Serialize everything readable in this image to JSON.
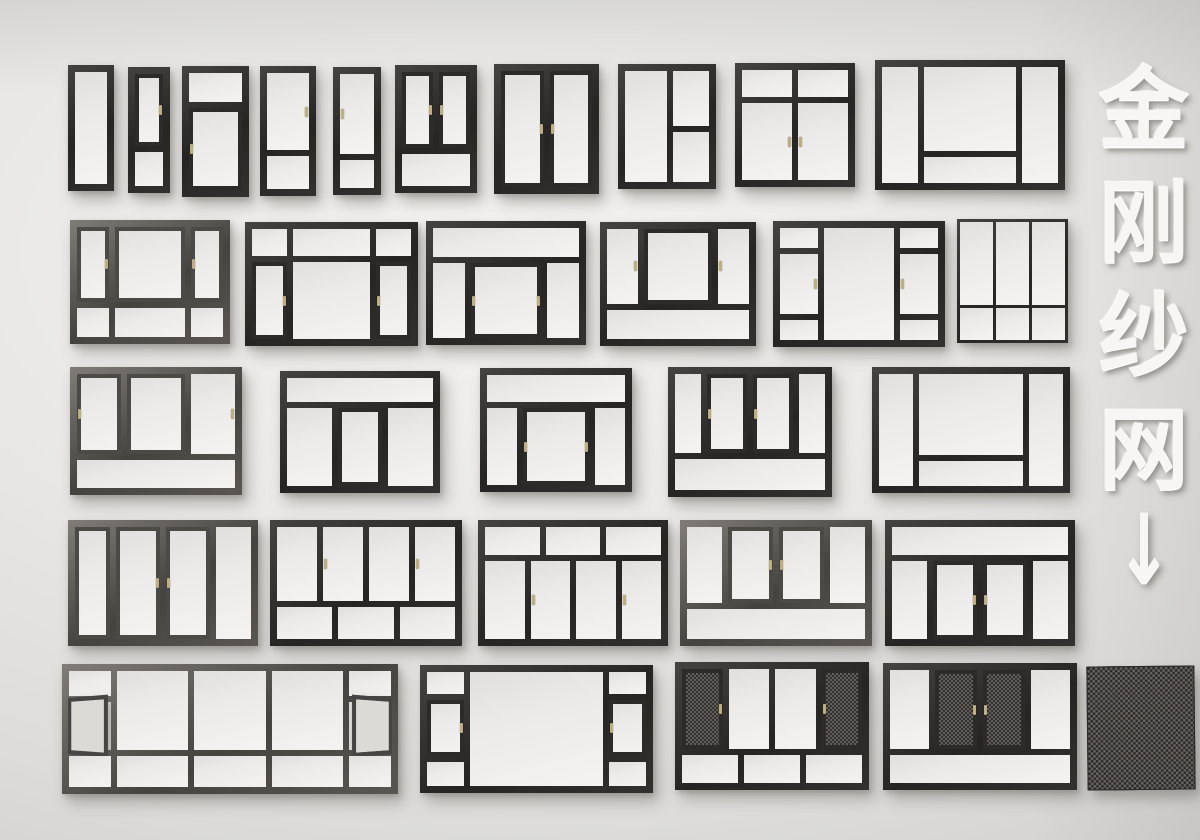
{
  "scene": {
    "title_vertical": {
      "text": "金刚纱网",
      "chars": [
        "金",
        "刚",
        "纱",
        "网"
      ],
      "arrow": "↓"
    },
    "colors": {
      "wall": "#e9e8e6",
      "frame_dark": "#2c2b29",
      "frame_steel": "#56534f",
      "glass": "#efeeec",
      "mesh": "#3f3d3b",
      "handle": "#bfae7f",
      "title_text": "#f7f6f4"
    }
  },
  "windows": [
    {
      "x": 68,
      "y": 65,
      "w": 46,
      "h": 126,
      "tone": "dark",
      "cols": "1fr",
      "rows": "1fr",
      "panes": [
        {
          "c": "1",
          "r": "1",
          "t": "g"
        }
      ]
    },
    {
      "x": 128,
      "y": 67,
      "w": 42,
      "h": 126,
      "tone": "dark",
      "cols": "1fr",
      "rows": "68fr 32fr",
      "panes": [
        {
          "c": "1",
          "r": "1",
          "t": "s",
          "h": "r"
        },
        {
          "c": "1",
          "r": "2",
          "t": "g"
        }
      ]
    },
    {
      "x": 182,
      "y": 66,
      "w": 67,
      "h": 131,
      "tone": "dark",
      "cols": "1fr",
      "rows": "26fr 74fr",
      "panes": [
        {
          "c": "1",
          "r": "1",
          "t": "g"
        },
        {
          "c": "1",
          "r": "2",
          "t": "s",
          "h": "l"
        }
      ]
    },
    {
      "x": 260,
      "y": 66,
      "w": 56,
      "h": 130,
      "tone": "dark",
      "cols": "1fr",
      "rows": "70fr 30fr",
      "panes": [
        {
          "c": "1",
          "r": "1",
          "t": "g",
          "h": "r"
        },
        {
          "c": "1",
          "r": "2",
          "t": "g"
        }
      ]
    },
    {
      "x": 333,
      "y": 67,
      "w": 48,
      "h": 128,
      "tone": "dark",
      "cols": "1fr",
      "rows": "74fr 26fr",
      "panes": [
        {
          "c": "1",
          "r": "1",
          "t": "g",
          "h": "l"
        },
        {
          "c": "1",
          "r": "2",
          "t": "g"
        }
      ]
    },
    {
      "x": 395,
      "y": 65,
      "w": 82,
      "h": 128,
      "tone": "dark",
      "cols": "1fr 1fr",
      "rows": "70fr 30fr",
      "panes": [
        {
          "c": "1",
          "r": "1",
          "t": "s",
          "h": "r"
        },
        {
          "c": "2",
          "r": "1",
          "t": "s",
          "h": "l"
        },
        {
          "c": "1/3",
          "r": "2",
          "t": "g"
        }
      ]
    },
    {
      "x": 494,
      "y": 64,
      "w": 105,
      "h": 130,
      "tone": "dark",
      "cols": "1fr 1fr",
      "rows": "1fr",
      "panes": [
        {
          "c": "1",
          "r": "1",
          "t": "s",
          "h": "r"
        },
        {
          "c": "2",
          "r": "1",
          "t": "s",
          "h": "l"
        }
      ]
    },
    {
      "x": 618,
      "y": 64,
      "w": 98,
      "h": 125,
      "tone": "dark",
      "cols": "54fr 46fr",
      "rows": "52fr 48fr",
      "panes": [
        {
          "c": "1",
          "r": "1/3",
          "t": "g"
        },
        {
          "c": "2",
          "r": "1",
          "t": "g"
        },
        {
          "c": "2",
          "r": "2",
          "t": "g"
        }
      ]
    },
    {
      "x": 735,
      "y": 63,
      "w": 120,
      "h": 124,
      "tone": "dark",
      "cols": "1fr 1fr",
      "rows": "26fr 74fr",
      "panes": [
        {
          "c": "1",
          "r": "1",
          "t": "g"
        },
        {
          "c": "2",
          "r": "1",
          "t": "g"
        },
        {
          "c": "1",
          "r": "2",
          "t": "g",
          "h": "r"
        },
        {
          "c": "2",
          "r": "2",
          "t": "g",
          "h": "l"
        }
      ]
    },
    {
      "x": 875,
      "y": 60,
      "w": 190,
      "h": 130,
      "tone": "dark",
      "cols": "22fr 56fr 22fr",
      "rows": "76fr 24fr",
      "panes": [
        {
          "c": "1",
          "r": "1/3",
          "t": "g"
        },
        {
          "c": "2",
          "r": "1",
          "t": "g"
        },
        {
          "c": "2",
          "r": "2",
          "t": "g"
        },
        {
          "c": "3",
          "r": "1/3",
          "t": "g"
        }
      ]
    },
    {
      "x": 70,
      "y": 220,
      "w": 160,
      "h": 124,
      "tone": "steel",
      "cols": "24fr 52fr 24fr",
      "rows": "72fr 28fr",
      "panes": [
        {
          "c": "1",
          "r": "1",
          "t": "s",
          "h": "r"
        },
        {
          "c": "2",
          "r": "1",
          "t": "s"
        },
        {
          "c": "3",
          "r": "1",
          "t": "s",
          "h": "l"
        },
        {
          "c": "1",
          "r": "2",
          "t": "g"
        },
        {
          "c": "2",
          "r": "2",
          "t": "g"
        },
        {
          "c": "3",
          "r": "2",
          "t": "g"
        }
      ]
    },
    {
      "x": 245,
      "y": 222,
      "w": 173,
      "h": 124,
      "tone": "dark",
      "cols": "24fr 52fr 24fr",
      "rows": "26fr 74fr",
      "panes": [
        {
          "c": "1",
          "r": "1",
          "t": "g"
        },
        {
          "c": "2",
          "r": "1",
          "t": "g"
        },
        {
          "c": "3",
          "r": "1",
          "t": "g"
        },
        {
          "c": "1",
          "r": "2",
          "t": "s",
          "h": "r"
        },
        {
          "c": "2",
          "r": "2",
          "t": "g"
        },
        {
          "c": "3",
          "r": "2",
          "t": "s",
          "h": "l"
        }
      ]
    },
    {
      "x": 426,
      "y": 221,
      "w": 160,
      "h": 124,
      "tone": "dark",
      "cols": "24fr 52fr 24fr",
      "rows": "28fr 72fr",
      "panes": [
        {
          "c": "1/4",
          "r": "1",
          "t": "g"
        },
        {
          "c": "1",
          "r": "2",
          "t": "g"
        },
        {
          "c": "2",
          "r": "2",
          "t": "s",
          "h": "lr"
        },
        {
          "c": "3",
          "r": "2",
          "t": "g"
        }
      ]
    },
    {
      "x": 600,
      "y": 222,
      "w": 156,
      "h": 124,
      "tone": "dark",
      "cols": "24fr 52fr 24fr",
      "rows": "72fr 28fr",
      "panes": [
        {
          "c": "1",
          "r": "1",
          "t": "g",
          "h": "r"
        },
        {
          "c": "2",
          "r": "1",
          "t": "s"
        },
        {
          "c": "3",
          "r": "1",
          "t": "g",
          "h": "l"
        },
        {
          "c": "1/4",
          "r": "2",
          "t": "g"
        }
      ]
    },
    {
      "x": 773,
      "y": 221,
      "w": 172,
      "h": 126,
      "tone": "dark",
      "cols": "26fr 48fr 26fr",
      "rows": "20fr 60fr 20fr",
      "panes": [
        {
          "c": "1",
          "r": "1",
          "t": "g"
        },
        {
          "c": "1",
          "r": "2",
          "t": "g",
          "h": "r"
        },
        {
          "c": "1",
          "r": "3",
          "t": "g"
        },
        {
          "c": "2",
          "r": "1/4",
          "t": "g"
        },
        {
          "c": "3",
          "r": "1",
          "t": "g"
        },
        {
          "c": "3",
          "r": "2",
          "t": "g",
          "h": "l"
        },
        {
          "c": "3",
          "r": "3",
          "t": "g"
        }
      ]
    },
    {
      "x": 957,
      "y": 219,
      "w": 111,
      "h": 124,
      "tone": "dark",
      "thin": true,
      "cols": "1fr 1fr 1fr",
      "rows": "72fr 28fr",
      "panes": [
        {
          "c": "1",
          "r": "1",
          "t": "g"
        },
        {
          "c": "2",
          "r": "1",
          "t": "g"
        },
        {
          "c": "3",
          "r": "1",
          "t": "g"
        },
        {
          "c": "1",
          "r": "2",
          "t": "g"
        },
        {
          "c": "2",
          "r": "2",
          "t": "g"
        },
        {
          "c": "3",
          "r": "2",
          "t": "g"
        }
      ]
    },
    {
      "x": 70,
      "y": 367,
      "w": 172,
      "h": 128,
      "tone": "steel",
      "cols": "30fr 40fr 30fr",
      "rows": "74fr 26fr",
      "panes": [
        {
          "c": "1",
          "r": "1",
          "t": "s",
          "h": "l"
        },
        {
          "c": "2",
          "r": "1",
          "t": "s"
        },
        {
          "c": "3",
          "r": "1",
          "t": "g",
          "h": "r"
        },
        {
          "c": "1/4",
          "r": "2",
          "t": "g"
        }
      ]
    },
    {
      "x": 280,
      "y": 371,
      "w": 160,
      "h": 122,
      "tone": "dark",
      "cols": "1fr 1fr 1fr",
      "rows": "24fr 76fr",
      "panes": [
        {
          "c": "1/4",
          "r": "1",
          "t": "g"
        },
        {
          "c": "1",
          "r": "2",
          "t": "g"
        },
        {
          "c": "2",
          "r": "2",
          "t": "s"
        },
        {
          "c": "3",
          "r": "2",
          "t": "g"
        }
      ]
    },
    {
      "x": 480,
      "y": 368,
      "w": 152,
      "h": 124,
      "tone": "dark",
      "cols": "24fr 52fr 24fr",
      "rows": "26fr 74fr",
      "panes": [
        {
          "c": "1/4",
          "r": "1",
          "t": "g"
        },
        {
          "c": "1",
          "r": "2",
          "t": "g"
        },
        {
          "c": "2",
          "r": "2",
          "t": "s",
          "h": "lr"
        },
        {
          "c": "3",
          "r": "2",
          "t": "g"
        }
      ]
    },
    {
      "x": 668,
      "y": 367,
      "w": 164,
      "h": 130,
      "tone": "dark",
      "cols": "20fr 30fr 30fr 20fr",
      "rows": "72fr 28fr",
      "panes": [
        {
          "c": "1",
          "r": "1",
          "t": "g"
        },
        {
          "c": "2",
          "r": "1",
          "t": "s",
          "h": "l"
        },
        {
          "c": "3",
          "r": "1",
          "t": "s",
          "h": "l"
        },
        {
          "c": "4",
          "r": "1",
          "t": "g"
        },
        {
          "c": "1/5",
          "r": "2",
          "t": "g"
        }
      ]
    },
    {
      "x": 872,
      "y": 367,
      "w": 198,
      "h": 126,
      "tone": "dark",
      "cols": "20fr 60fr 20fr",
      "rows": "76fr 24fr",
      "panes": [
        {
          "c": "1",
          "r": "1/3",
          "t": "g"
        },
        {
          "c": "2",
          "r": "1",
          "t": "g"
        },
        {
          "c": "2",
          "r": "2",
          "t": "g"
        },
        {
          "c": "3",
          "r": "1/3",
          "t": "g"
        }
      ]
    },
    {
      "x": 68,
      "y": 520,
      "w": 190,
      "h": 126,
      "tone": "steel",
      "cols": "22fr 28fr 28fr 22fr",
      "rows": "1fr",
      "panes": [
        {
          "c": "1",
          "r": "1",
          "t": "s"
        },
        {
          "c": "2",
          "r": "1",
          "t": "s",
          "h": "r"
        },
        {
          "c": "3",
          "r": "1",
          "t": "s",
          "h": "l"
        },
        {
          "c": "4",
          "r": "1",
          "t": "g"
        }
      ]
    },
    {
      "x": 270,
      "y": 520,
      "w": 192,
      "h": 126,
      "tone": "dark",
      "cols": "repeat(12,1fr)",
      "rows": "70fr 30fr",
      "panes": [
        {
          "c": "1/4",
          "r": "1",
          "t": "g"
        },
        {
          "c": "4/7",
          "r": "1",
          "t": "g",
          "h": "l"
        },
        {
          "c": "7/10",
          "r": "1",
          "t": "g"
        },
        {
          "c": "10/13",
          "r": "1",
          "t": "g",
          "h": "l"
        },
        {
          "c": "1/5",
          "r": "2",
          "t": "g"
        },
        {
          "c": "5/9",
          "r": "2",
          "t": "g"
        },
        {
          "c": "9/13",
          "r": "2",
          "t": "g"
        }
      ]
    },
    {
      "x": 478,
      "y": 520,
      "w": 190,
      "h": 126,
      "tone": "dark",
      "cols": "repeat(12,1fr)",
      "rows": "26fr 74fr",
      "panes": [
        {
          "c": "1/5",
          "r": "1",
          "t": "g"
        },
        {
          "c": "5/9",
          "r": "1",
          "t": "g"
        },
        {
          "c": "9/13",
          "r": "1",
          "t": "g"
        },
        {
          "c": "1/4",
          "r": "2",
          "t": "g"
        },
        {
          "c": "4/7",
          "r": "2",
          "t": "g",
          "h": "l"
        },
        {
          "c": "7/10",
          "r": "2",
          "t": "g"
        },
        {
          "c": "10/13",
          "r": "2",
          "t": "g",
          "h": "l"
        }
      ]
    },
    {
      "x": 680,
      "y": 520,
      "w": 192,
      "h": 126,
      "tone": "steel",
      "cols": "22fr 28fr 28fr 22fr",
      "rows": "72fr 28fr",
      "panes": [
        {
          "c": "1",
          "r": "1",
          "t": "g"
        },
        {
          "c": "2",
          "r": "1",
          "t": "s",
          "h": "r"
        },
        {
          "c": "3",
          "r": "1",
          "t": "s",
          "h": "l"
        },
        {
          "c": "4",
          "r": "1",
          "t": "g"
        },
        {
          "c": "1/5",
          "r": "2",
          "t": "g"
        }
      ]
    },
    {
      "x": 885,
      "y": 520,
      "w": 190,
      "h": 126,
      "tone": "dark",
      "cols": "22fr 28fr 28fr 22fr",
      "rows": "26fr 74fr",
      "panes": [
        {
          "c": "1/5",
          "r": "1",
          "t": "g"
        },
        {
          "c": "1",
          "r": "2",
          "t": "g"
        },
        {
          "c": "2",
          "r": "2",
          "t": "s",
          "h": "r"
        },
        {
          "c": "3",
          "r": "2",
          "t": "s",
          "h": "l"
        },
        {
          "c": "4",
          "r": "2",
          "t": "g"
        }
      ]
    },
    {
      "x": 62,
      "y": 664,
      "w": 336,
      "h": 130,
      "tone": "steel",
      "cols": "14fr 24fr 24fr 24fr 14fr",
      "rows": "24fr 46fr 30fr",
      "panes": [
        {
          "c": "1",
          "r": "1",
          "t": "g"
        },
        {
          "c": "1",
          "r": "2",
          "t": "oL"
        },
        {
          "c": "1",
          "r": "3",
          "t": "g"
        },
        {
          "c": "2",
          "r": "1/3",
          "t": "g"
        },
        {
          "c": "2",
          "r": "3",
          "t": "g"
        },
        {
          "c": "3",
          "r": "1/3",
          "t": "g"
        },
        {
          "c": "3",
          "r": "3",
          "t": "g"
        },
        {
          "c": "4",
          "r": "1/3",
          "t": "g"
        },
        {
          "c": "4",
          "r": "3",
          "t": "g"
        },
        {
          "c": "5",
          "r": "1",
          "t": "g"
        },
        {
          "c": "5",
          "r": "2",
          "t": "oR"
        },
        {
          "c": "5",
          "r": "3",
          "t": "g"
        }
      ]
    },
    {
      "x": 420,
      "y": 665,
      "w": 233,
      "h": 128,
      "tone": "dark",
      "cols": "18fr 64fr 18fr",
      "rows": "22fr 54fr 24fr",
      "panes": [
        {
          "c": "1",
          "r": "1",
          "t": "g"
        },
        {
          "c": "1",
          "r": "2",
          "t": "s",
          "h": "r"
        },
        {
          "c": "1",
          "r": "3",
          "t": "g"
        },
        {
          "c": "2",
          "r": "1/4",
          "t": "g"
        },
        {
          "c": "3",
          "r": "1",
          "t": "g"
        },
        {
          "c": "3",
          "r": "2",
          "t": "s",
          "h": "l"
        },
        {
          "c": "3",
          "r": "3",
          "t": "g"
        }
      ]
    },
    {
      "x": 675,
      "y": 662,
      "w": 194,
      "h": 128,
      "tone": "dark",
      "cols": "repeat(12,1fr)",
      "rows": "74fr 26fr",
      "panes": [
        {
          "c": "1/4",
          "r": "1",
          "t": "m",
          "h": "r"
        },
        {
          "c": "4/7",
          "r": "1",
          "t": "g"
        },
        {
          "c": "7/10",
          "r": "1",
          "t": "g"
        },
        {
          "c": "10/13",
          "r": "1",
          "t": "m",
          "h": "l"
        },
        {
          "c": "1/5",
          "r": "2",
          "t": "g"
        },
        {
          "c": "5/9",
          "r": "2",
          "t": "g"
        },
        {
          "c": "9/13",
          "r": "2",
          "t": "g"
        }
      ]
    },
    {
      "x": 883,
      "y": 663,
      "w": 194,
      "h": 127,
      "tone": "dark",
      "cols": "24fr 26fr 26fr 24fr",
      "rows": "74fr 26fr",
      "panes": [
        {
          "c": "1",
          "r": "1",
          "t": "g"
        },
        {
          "c": "2",
          "r": "1",
          "t": "m",
          "h": "r"
        },
        {
          "c": "3",
          "r": "1",
          "t": "m",
          "h": "l"
        },
        {
          "c": "4",
          "r": "1",
          "t": "g"
        },
        {
          "c": "1/5",
          "r": "2",
          "t": "g"
        }
      ]
    }
  ],
  "swatch": {
    "x": 1087,
    "y": 666,
    "w": 106,
    "h": 122
  }
}
